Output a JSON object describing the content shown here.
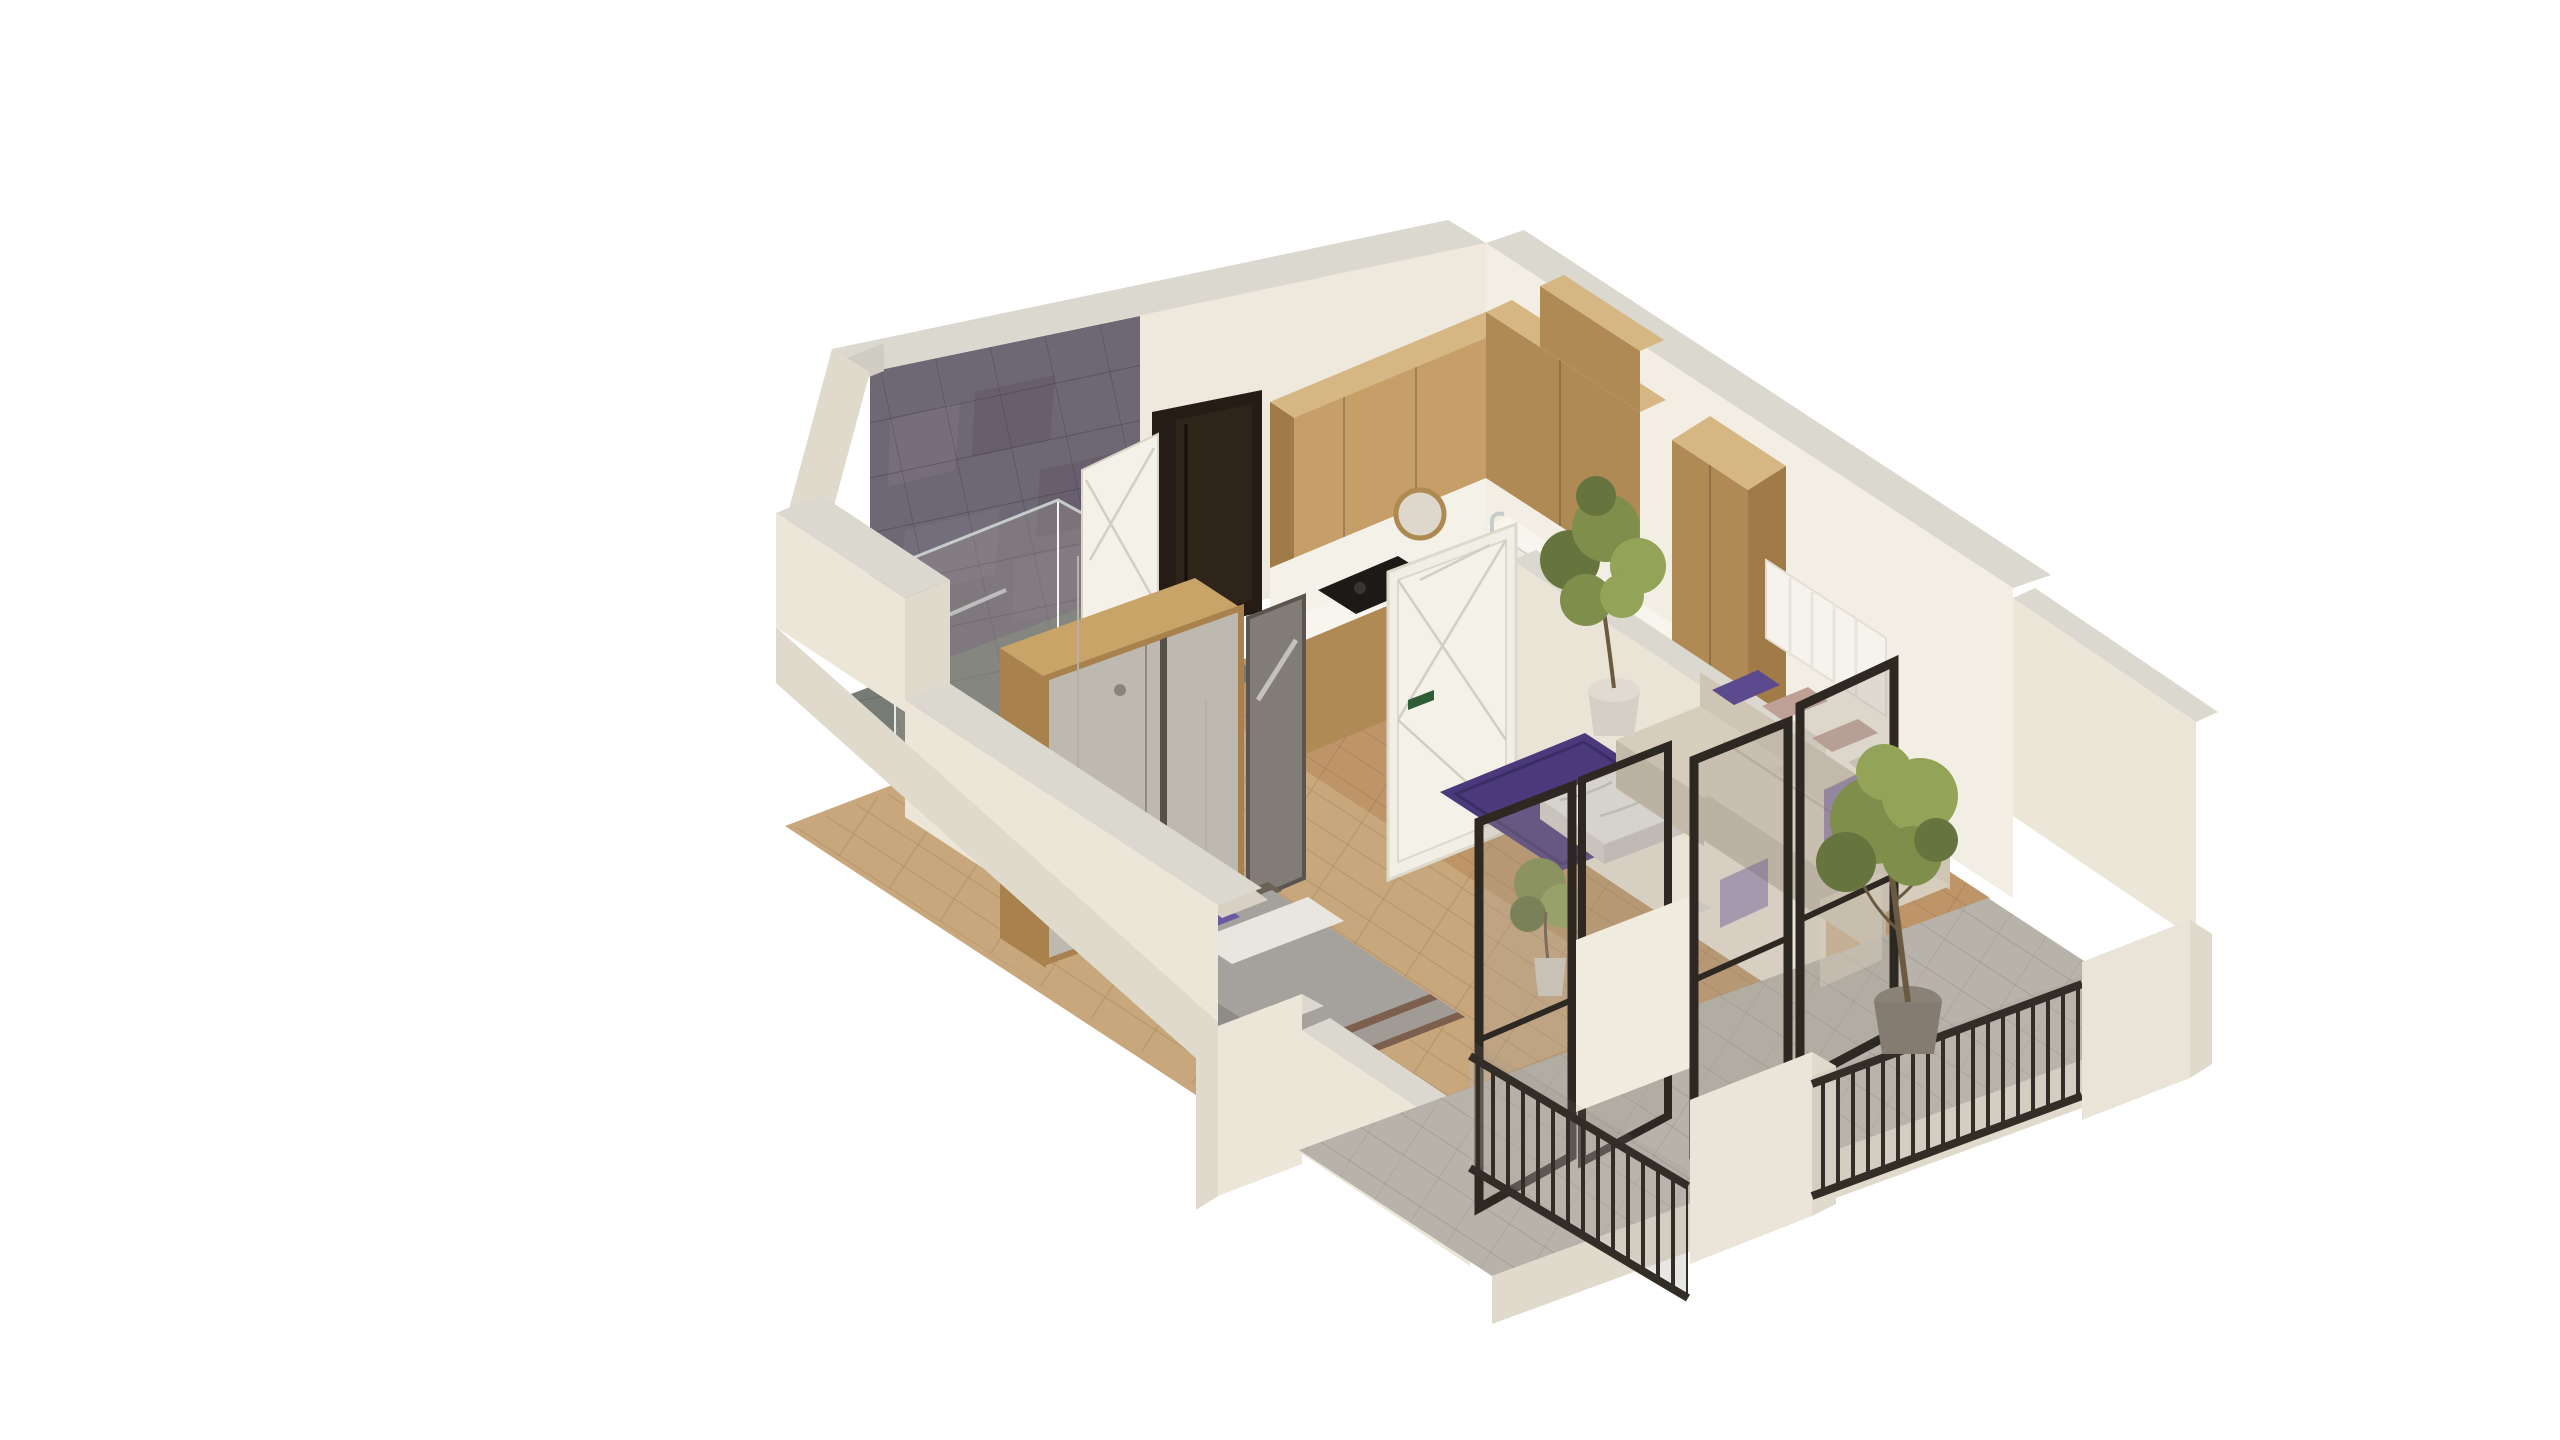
{
  "meta": {
    "title": "Isometric 3D cutaway floor plan of a one-bedroom apartment",
    "view": "axonometric cutaway from south-west above",
    "background": "#ffffff"
  },
  "palette": {
    "bg": "#ffffff",
    "wall": "#efe9dd",
    "wallLit": "#f3eee3",
    "wallShade": "#eae4d6",
    "wallOuter": "#ece6d9",
    "wallTop": "#dbd8cf",
    "wallTopDark": "#cfccc2",
    "capShade": "#e0dacc",
    "tile": "#6e6774",
    "tileLight": "#7d7584",
    "tileDark": "#5f5964",
    "bathFloor": "#767b76",
    "woodCab": "#c59e68",
    "woodCabShade": "#b08a54",
    "woodCabDark": "#a07a47",
    "woodCabTop": "#d6b683",
    "floorWood": "#bd9568",
    "floorWoodLight": "#c9a77c",
    "balconyFloor": "#b7b3aa",
    "counter": "#f7f5ee",
    "backsplash": "#f4f1e8",
    "cooktop": "#1c1916",
    "doorDark": "#241c15",
    "doorWhite": "#f4f1e9",
    "doorLine": "#d2cec2",
    "handleGreen": "#2f5d35",
    "wardrobeDoor": "#bdb9b1",
    "wardrobeWood": "#c9a469",
    "wardrobeWoodDark": "#a8814d",
    "mirror": "#817c75",
    "bedBlanket": "#a5a29d",
    "bedSide": "#8f8c87",
    "bedSheet": "#e9e6e0",
    "bedTrim": "#7c5f4c",
    "headboard": "#6b6256",
    "pillowPurple": "#5c4a8e",
    "pillowPurpleLight": "#6a58a0",
    "pillowBlush": "#bfa097",
    "pillowCream": "#d8d0c2",
    "sofa": "#d6cdbd",
    "sofaShade": "#c4baa9",
    "sofaBack": "#cec5b5",
    "rug": "#4a3a7c",
    "tableTop": "#eae8e4",
    "tableSide": "#d6d3cd",
    "frameDark": "#2d2822",
    "railing": "#332d27",
    "glassTint": "rgba(170,160,148,0.30)",
    "glassTintStrong": "rgba(150,145,135,0.45)",
    "leaf": "#7f8f4b",
    "leafLight": "#93a358",
    "leafDark": "#66753e",
    "trunk": "#6b5a42",
    "potDark": "#847c70",
    "potLight": "#d5d0c5",
    "chrome": "#c6cbcc",
    "radiator": "#f6f3ec"
  },
  "scene": {
    "rooms": [
      {
        "name": "bathroom",
        "features": [
          "dark-marble-tiled-wall",
          "tiled-floor",
          "glass-shower",
          "toilet",
          "shower-mat",
          "towel-bar"
        ]
      },
      {
        "name": "hallway",
        "features": [
          "wardrobe",
          "entry-door",
          "leaning-mirror",
          "pendant-lamps",
          "white-door-ajar",
          "dark-doorway"
        ]
      },
      {
        "name": "kitchen",
        "features": [
          "l-shaped-upper-cabinets",
          "white-countertop",
          "cooktop",
          "sink",
          "round-gold-mirror",
          "tall-cabinet",
          "wood-floor"
        ]
      },
      {
        "name": "living-room",
        "features": [
          "corner-sofa",
          "purple-rug",
          "marble-coffee-table",
          "radiator",
          "potted-ficus"
        ]
      },
      {
        "name": "bedroom",
        "features": [
          "double-bed",
          "purple-pillows",
          "gray-blanket",
          "low-front-wall"
        ]
      },
      {
        "name": "balcony",
        "features": [
          "two-black-framed-glass-doors",
          "white-piers",
          "metal-bar-railings",
          "olive-tree-in-pot",
          "small-potted-plant"
        ]
      }
    ],
    "plants": 3,
    "doors": {
      "entry": "white with diagonal moldings and green handle",
      "balcony": "black-framed glass",
      "bathroom": "white leaf ajar beside dark doorway"
    }
  }
}
